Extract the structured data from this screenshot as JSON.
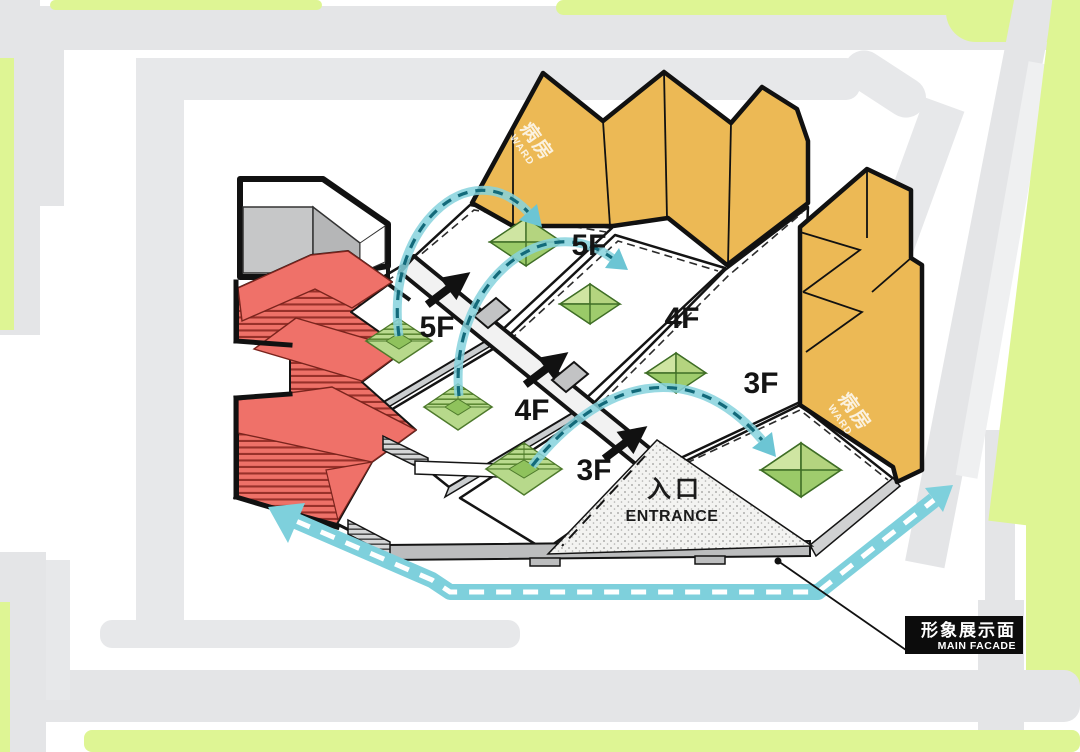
{
  "buildings": {
    "ward": {
      "name_cn": "病房",
      "name_en": "WARD",
      "fill": "#ecb955"
    },
    "red_tower": {
      "fill": "#ee7168"
    },
    "gray_annex": {
      "fill": "#c6c7c8"
    }
  },
  "floor_labels": {
    "left": [
      "5F",
      "4F",
      "3F"
    ],
    "right": [
      "5F",
      "4F",
      "3F"
    ]
  },
  "entrance": {
    "cn": "入口",
    "en": "ENTRANCE"
  },
  "main_facade": {
    "cn": "形象展示面",
    "en": "MAIN FACADE"
  },
  "colors": {
    "circulation_band": "#7ed0dc",
    "arc_dash": "#136a7a",
    "courtyard_green": "#aed37f",
    "terrace_green": "#b9da8e",
    "map_road_gray": "#e4e5e7",
    "map_green": "#def594",
    "ward_yellow": "#ecb955",
    "red": "#ee7168",
    "label_box_black": "#0c0c0c"
  }
}
